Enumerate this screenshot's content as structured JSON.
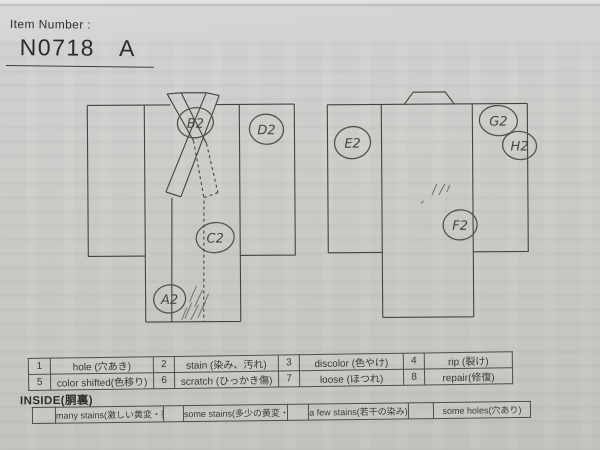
{
  "header": {
    "item_label": "Item Number :",
    "item_number": "N0718",
    "item_suffix": "A"
  },
  "diagram": {
    "labels": {
      "a2": "A2",
      "b2": "B2",
      "c2": "C2",
      "d2": "D2",
      "e2": "E2",
      "f2": "F2",
      "g2": "G2",
      "h2": "H2"
    }
  },
  "legend": {
    "rows": [
      [
        "1",
        "hole (穴あき)",
        "2",
        "stain (染み、汚れ)",
        "3",
        "discolor (色やけ)",
        "4",
        "rip (裂け)"
      ],
      [
        "5",
        "color shifted(色移り)",
        "6",
        "scratch (ひっかき傷)",
        "7",
        "loose (ほつれ)",
        "8",
        "repair(修復)"
      ]
    ]
  },
  "inside": {
    "title": "INSIDE(胴裏)",
    "cells": [
      "",
      "many stains(激しい黄変・染み)",
      "",
      "some stains(多少の黄変・染み)",
      "",
      "a few stains(若干の染み)",
      "",
      "some holes(穴あり)"
    ]
  },
  "colors": {
    "paper": "#cecec9",
    "ink": "#44443f",
    "pencil": "#57524d",
    "table_border": "#4e4e4a"
  }
}
